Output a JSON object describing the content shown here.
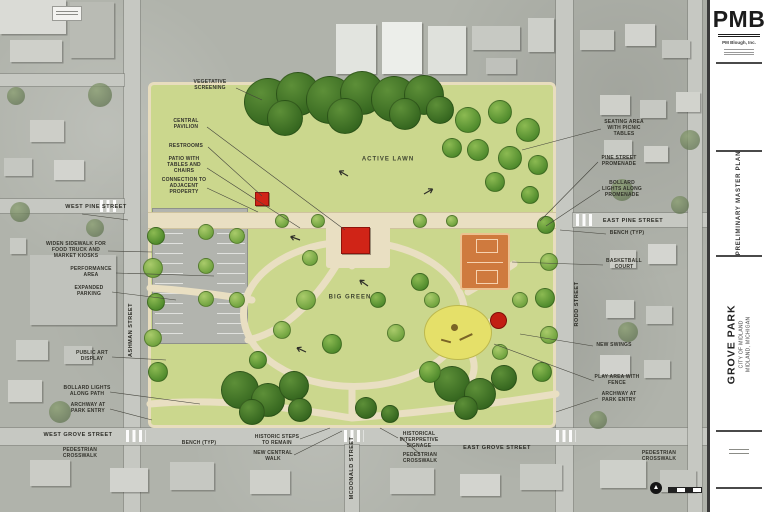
{
  "sheet": {
    "firm_logo": "PMB",
    "firm_name": "PM Blough, Inc.",
    "sheet_title": "PRELIMINARY MASTER PLAN",
    "project_name": "GROVE PARK",
    "project_city": "CITY OF MIDLAND",
    "project_state": "MIDLAND, MICHIGAN"
  },
  "map": {
    "area_labels": {
      "active_lawn": "ACTIVE LAWN",
      "big_green": "BIG GREEN"
    },
    "street_labels": {
      "west_pine": "WEST PINE STREET",
      "east_pine": "EAST PINE STREET",
      "west_grove": "WEST GROVE STREET",
      "east_grove": "EAST GROVE STREET",
      "ashman": "ASHMAN STREET",
      "rodd": "RODD STREET",
      "mcdonald": "MCDONALD STREET"
    },
    "callouts": {
      "veg_screening": "VEGETATIVE SCREENING",
      "central_pavilion": "CENTRAL PAVILION",
      "restrooms": "RESTROOMS",
      "patio_tables_chairs": "PATIO WITH TABLES AND CHAIRS",
      "connection_adjacent": "CONNECTION TO ADJACENT PROPERTY",
      "widen_sidewalk": "WIDEN SIDEWALK FOR FOOD TRUCK AND MARKET KIOSKS",
      "performance_area": "PERFORMANCE AREA",
      "expanded_parking": "EXPANDED PARKING",
      "public_art_display": "PUBLIC ART DISPLAY",
      "bollard_lights_path": "BOLLARD LIGHTS ALONG PATH",
      "archway_entry_west": "ARCHWAY AT PARK ENTRY",
      "ped_crosswalk_west": "PEDESTRIAN CROSSWALK",
      "bench_typ_south": "BENCH (TYP)",
      "historic_steps": "HISTORIC STEPS TO REMAIN",
      "new_central_walk": "NEW CENTRAL WALK",
      "historical_signage": "HISTORICAL INTERPRETIVE SIGNAGE",
      "ped_crosswalk_center": "PEDESTRIAN CROSSWALK",
      "ped_crosswalk_east": "PEDESTRIAN CROSSWALK",
      "archway_entry_east": "ARCHWAY AT PARK ENTRY",
      "play_area_fence": "PLAY AREA WITH FENCE",
      "new_swings": "NEW SWINGS",
      "basketball_court": "BASKETBALL COURT",
      "bench_typ_east": "BENCH (TYP)",
      "bollard_lights_promenade": "BOLLARD LIGHTS ALONG PROMENADE",
      "pine_street_promenade": "PINE STREET PROMENADE",
      "seating_picnic": "SEATING AREA WITH PICNIC TABLES"
    },
    "colors": {
      "lawn": "#cbd78d",
      "path": "#e9dfc2",
      "tree_dark": "#35661f",
      "tree_mid": "#4f8a2c",
      "tree_light": "#6fa23e",
      "parking": "#b2b4ae",
      "court_orange": "#cf7a3e",
      "feature_red": "#d02417",
      "play_yellow": "#e5e069",
      "aerial_base": "#b0b3ab",
      "road": "#c6c8c2"
    }
  }
}
